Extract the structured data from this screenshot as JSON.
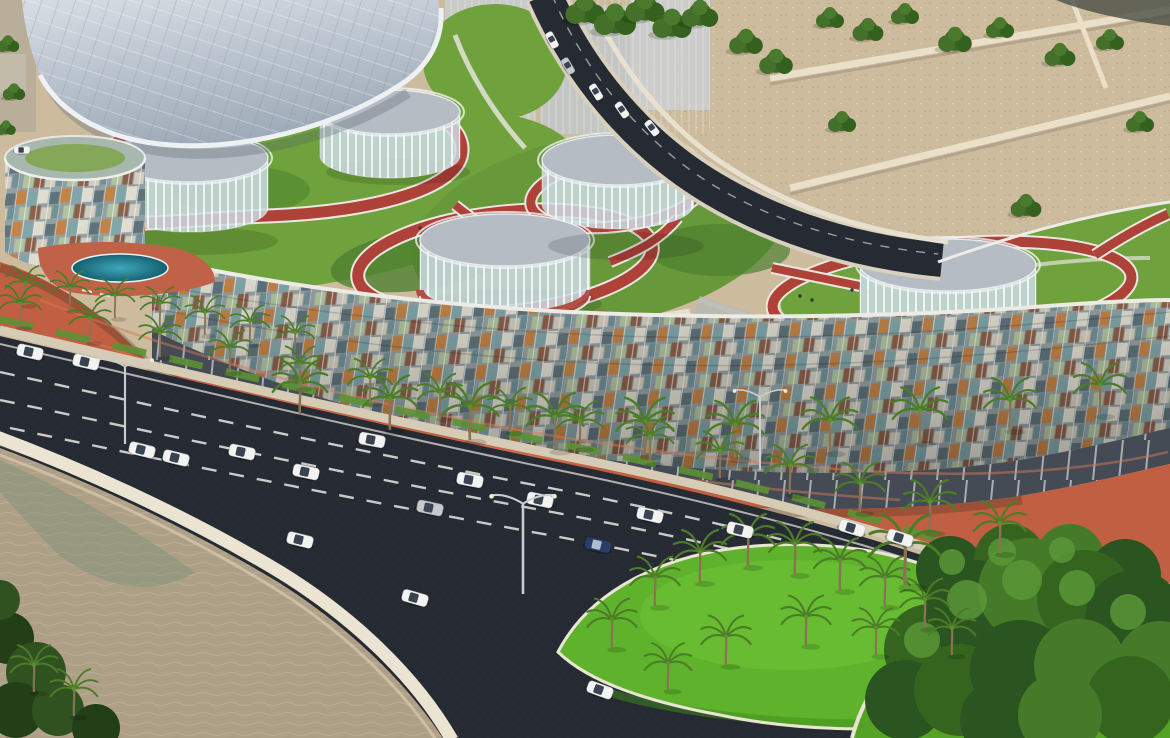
{
  "meta": {
    "type": "3d-architectural-rendering",
    "view": "aerial-oblique",
    "setting": "desert-waterfront",
    "time_of_day": "day"
  },
  "scene": {
    "description": "Aerial rendering of a sinuous low-rise residential complex raised on slender stilts with a multicoloured glass mosaic facade. The landscaped roof carries lawns, red running tracks, circular glass pavilion drums and a sweeping white canopy shell. A palm-lined multi-lane highway with traffic curves around the site past a sea wall and shallow beach water, with desert lots behind, a palm-planted median island and a dense tree-covered roundabout in the foreground.",
    "landmarks": [
      "crescent-building",
      "rooftop-running-track",
      "glass-pavilion-drums",
      "white-canopy-shell",
      "rooftop-pool",
      "coastal-highway",
      "palm-median-island",
      "roundabout-grove",
      "seawall",
      "beach-shallows",
      "desert-lots",
      "access-road"
    ]
  },
  "palette": {
    "sand": "#cdbb9e",
    "sand_light": "#dfd3b8",
    "desert_wall": "#eadfc8",
    "canopy_light": "#d6dde4",
    "canopy_dark": "#9fabb8",
    "glass_haze": "#c9d0d4",
    "roof_grass": "#6fa23c",
    "grass_dark": "#4f8030",
    "grass_bright": "#5fb32c",
    "roundabout_grass": "#55a326",
    "track_red": "#ae4238",
    "track_edge": "#e9e7e0",
    "walkway": "#e6e4d8",
    "plaza": "#b7bab2",
    "pool_teal": "#2c8ba0",
    "promenade": "#c05f41",
    "promenade_light": "#d37a58",
    "facade_base": "#93a0a3",
    "parapet": "#edebe5",
    "mosaic_tiles": [
      "#c7803f",
      "#7ea6aa",
      "#e7e2d4",
      "#5c6f76",
      "#b5c79e",
      "#8c5a42"
    ],
    "stilts": "#454b54",
    "road_asphalt": "#262b33",
    "lane_mark": "#e8e8e2",
    "road_casing": "#d8d0bc",
    "sidewalk": "#d6ccb6",
    "seawall": "#ece4d2",
    "water_sand": "#ae9f87",
    "water_green": "#7d9178",
    "vegetation_dark": "#2c4c1e",
    "tree_green": "#3f6628",
    "palm_frond": "#4c7c28",
    "palm_trunk": "#8a7355",
    "car_white": "#f3f4f2",
    "car_blue": "#2c3e66",
    "car_grey": "#c6c9cd",
    "drum_roof": "#b5bcc4",
    "drum_glass": "#cfdfe6"
  },
  "objects": {
    "pavilion_drums": 5,
    "running_track_loops": 4,
    "palm_trees": 48,
    "desert_trees": 19,
    "cars": 24,
    "street_lights": 3,
    "lane_marking_rows": 3,
    "median_islands": 1,
    "roundabouts": 1,
    "pools": 1
  }
}
